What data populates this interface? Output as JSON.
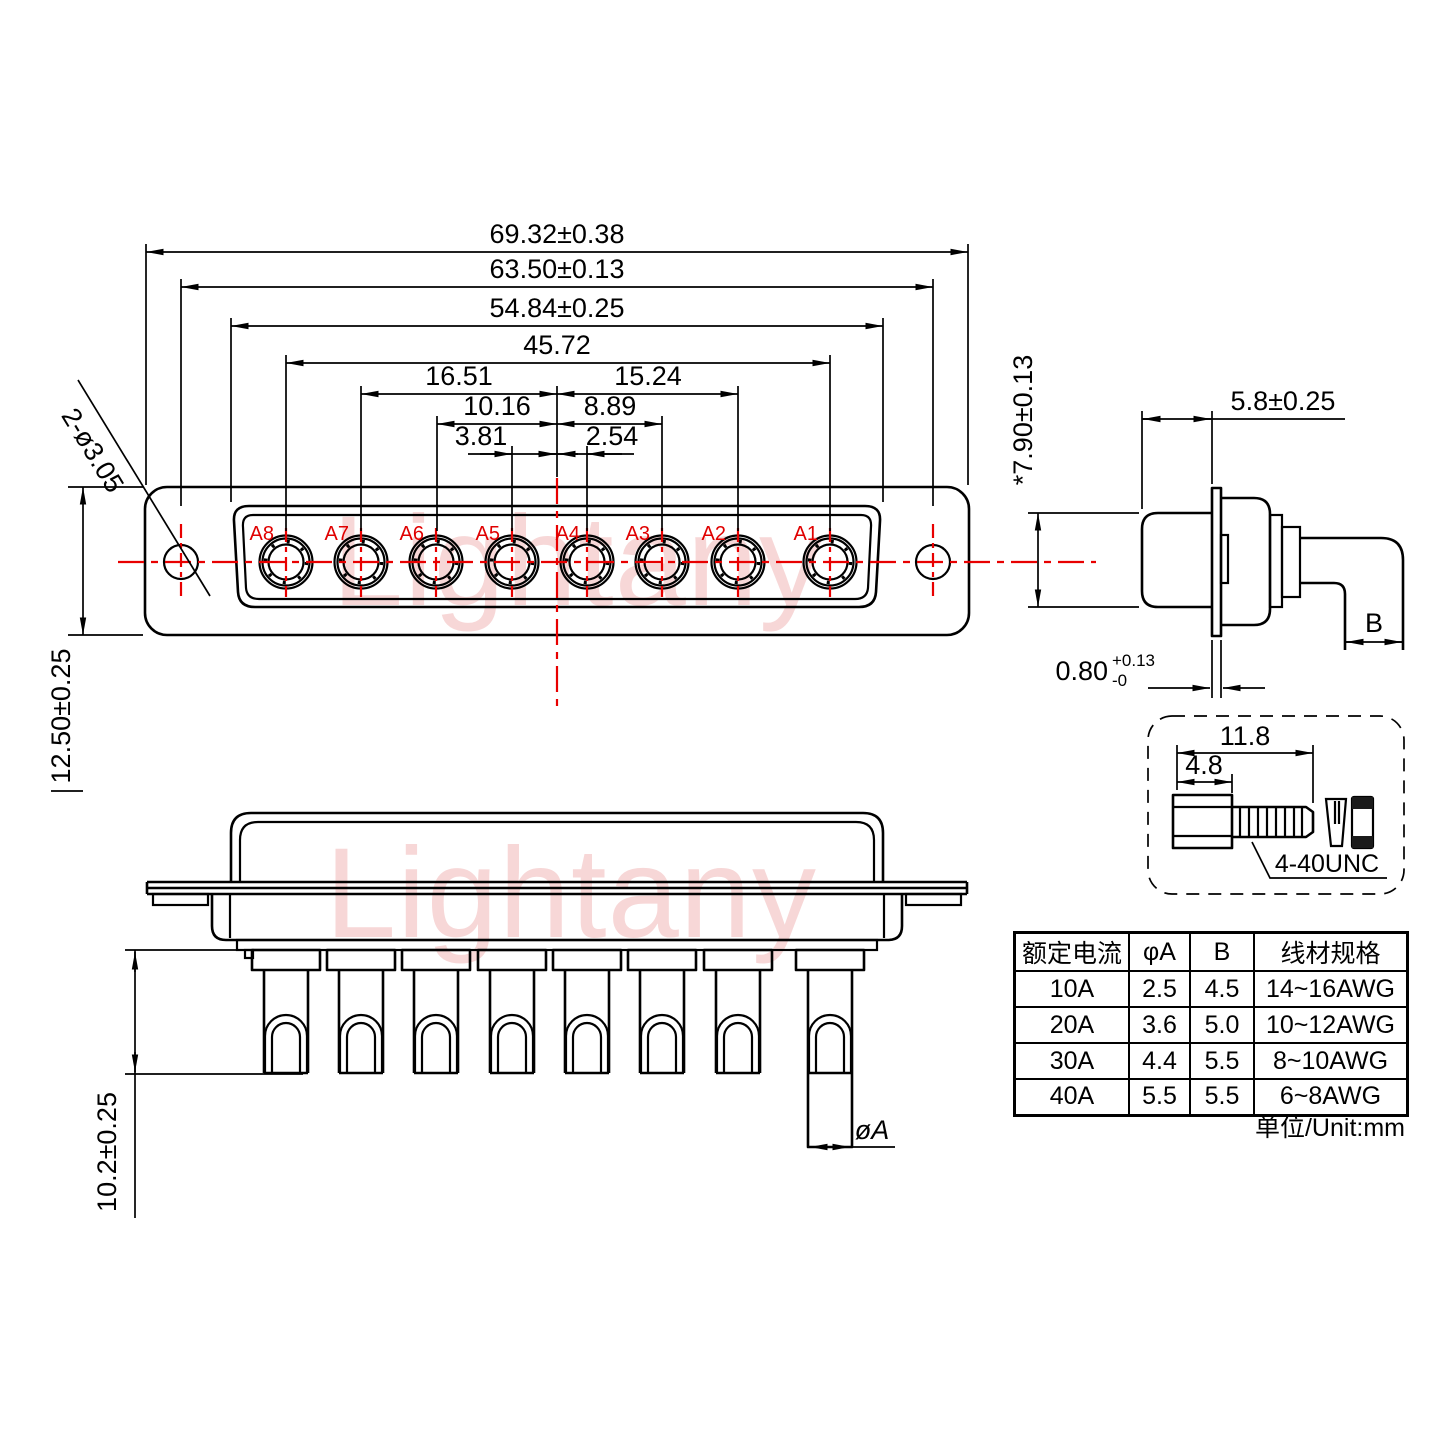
{
  "watermark": {
    "text": "Lightany"
  },
  "front": {
    "dims": {
      "d1": "69.32±0.38",
      "d2": "63.50±0.13",
      "d3": "54.84±0.25",
      "d4": "45.72",
      "d5l": "16.51",
      "d5r": "15.24",
      "d6l": "10.16",
      "d6r": "8.89",
      "d7l": "3.81",
      "d7r": "2.54",
      "holes": "2-ø3.05",
      "height": "12.50±0.25"
    },
    "pins": [
      "A8",
      "A7",
      "A6",
      "A5",
      "A4",
      "A3",
      "A2",
      "A1"
    ]
  },
  "side": {
    "dims": {
      "depth": "5.8±0.25",
      "face": "*7.90±0.13",
      "flange": "0.80",
      "flange_tol_up": "+0.13",
      "flange_tol_dn": "-0",
      "wire": "B"
    }
  },
  "bottom": {
    "dims": {
      "pin_len": "10.2±0.25",
      "pin_dia": "øA"
    }
  },
  "screw": {
    "dims": {
      "len": "11.8",
      "head": "4.8"
    },
    "thread": "4-40UNC"
  },
  "table": {
    "headers": [
      "额定电流",
      "φA",
      "B",
      "线材规格"
    ],
    "rows": [
      [
        "10A",
        "2.5",
        "4.5",
        "14~16AWG"
      ],
      [
        "20A",
        "3.6",
        "5.0",
        "10~12AWG"
      ],
      [
        "30A",
        "4.4",
        "5.5",
        "8~10AWG"
      ],
      [
        "40A",
        "5.5",
        "5.5",
        "6~8AWG"
      ]
    ],
    "unit": "单位/Unit:mm"
  }
}
